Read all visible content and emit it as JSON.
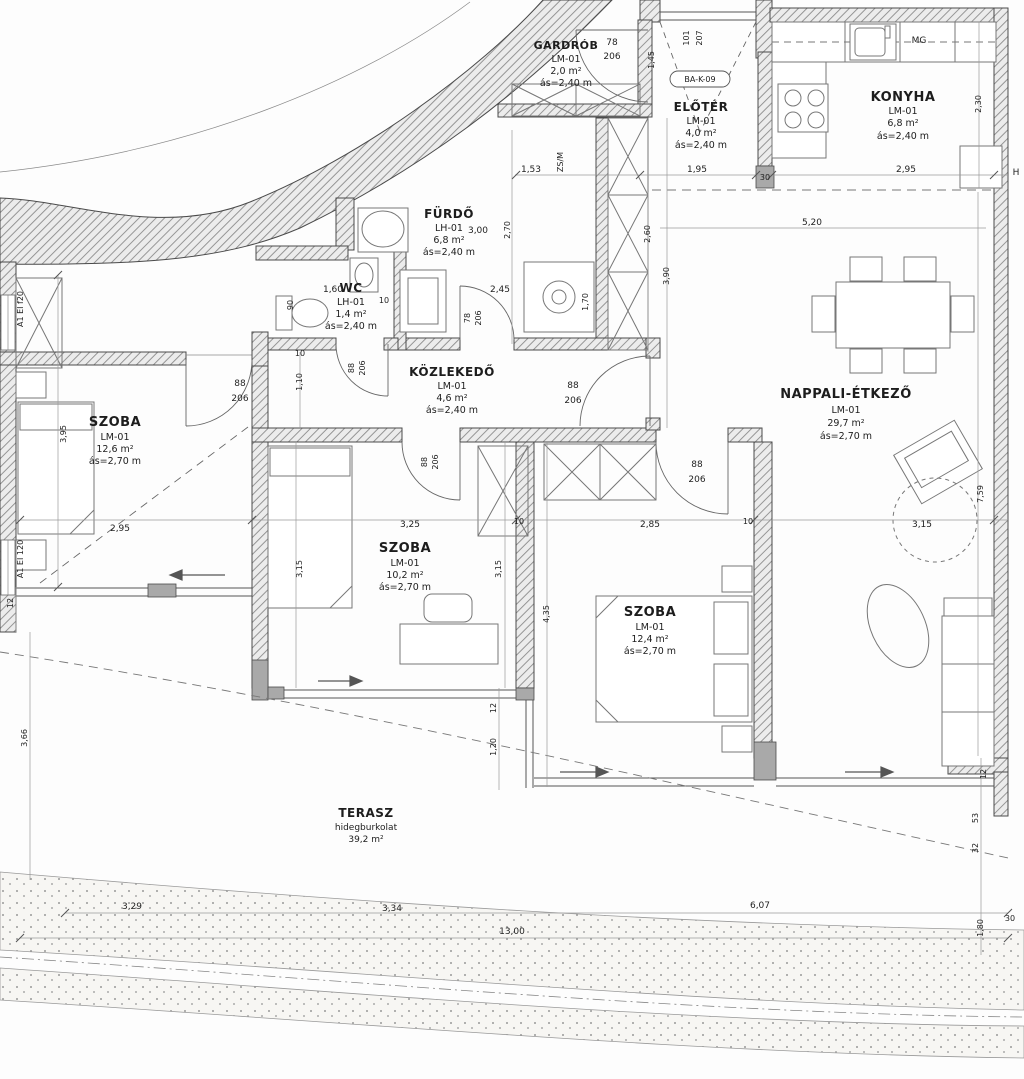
{
  "document": {
    "type": "apartment floor plan"
  },
  "rooms": [
    {
      "name": "GARDRÓB",
      "code": "LM-01",
      "area": "2,0 m²",
      "height": "ás=2,40 m"
    },
    {
      "name": "ELŐTÉR",
      "code": "LM-01",
      "area": "4,0 m²",
      "height": "ás=2,40 m"
    },
    {
      "name": "KONYHA",
      "code": "LM-01",
      "area": "6,8 m²",
      "height": "ás=2,40 m"
    },
    {
      "name": "FÜRDŐ",
      "code": "LH-01",
      "area": "6,8 m²",
      "height": "ás=2,40 m"
    },
    {
      "name": "WC",
      "code": "LH-01",
      "area": "1,4 m²",
      "height": "ás=2,40 m"
    },
    {
      "name": "KÖZLEKEDŐ",
      "code": "LM-01",
      "area": "4,6 m²",
      "height": "ás=2,40 m"
    },
    {
      "name": "NAPPALI-ÉTKEZŐ",
      "code": "LM-01",
      "area": "29,7 m²",
      "height": "ás=2,70 m"
    },
    {
      "name": "SZOBA",
      "code": "LM-01",
      "area": "12,6 m²",
      "height": "ás=2,70 m"
    },
    {
      "name": "SZOBA",
      "code": "LM-01",
      "area": "10,2 m²",
      "height": "ás=2,70 m"
    },
    {
      "name": "SZOBA",
      "code": "LM-01",
      "area": "12,4 m²",
      "height": "ás=2,70 m"
    },
    {
      "name": "TERASZ",
      "code": "hidegburkolat",
      "area": "39,2 m²",
      "height": ""
    }
  ],
  "labels": {
    "entry_code": "BA-K-09",
    "appliance_mg": "MG",
    "appliance_zsm": "ZS/M",
    "marker_h": "H",
    "window_a": "A1 EI f20",
    "window_b": "A1 EI 120"
  },
  "dims": {
    "gdw": "78",
    "gdh": "206",
    "e145": "1,45",
    "e101": "101",
    "e207": "207",
    "t153": "1,53",
    "t195": "1,95",
    "box30": "30",
    "t295": "2,95",
    "k230": "2,30",
    "f300": "3,00",
    "f270": "2,70",
    "w160": "1,60",
    "w10": "10",
    "w90": "90",
    "s245": "2,45",
    "s170": "1,70",
    "fdw": "78",
    "fdh": "206",
    "wdw": "88",
    "wdh": "206",
    "ldw": "88",
    "ldh": "206",
    "c110": "1,10",
    "c10": "10",
    "ndw": "88",
    "ndh": "206",
    "mdw": "88",
    "mdh": "206",
    "rdw": "88",
    "rdh": "206",
    "l395": "3,95",
    "l295": "2,95",
    "m325": "3,25",
    "m10a": "10",
    "m285": "2,85",
    "m10b": "10",
    "m315": "3,15",
    "v315a": "3,15",
    "v315b": "3,15",
    "v435": "4,35",
    "v759": "7,59",
    "n260": "2,60",
    "n390": "3,90",
    "n520": "5,20",
    "b12": "12",
    "b366": "3,66",
    "p12": "12",
    "p120": "1,20",
    "r12": "12",
    "r53": "53",
    "r32": "32",
    "r180": "1,80",
    "r30": "30",
    "g329": "3,29",
    "g334": "3,34",
    "g1300": "13,00",
    "g607": "6,07"
  }
}
